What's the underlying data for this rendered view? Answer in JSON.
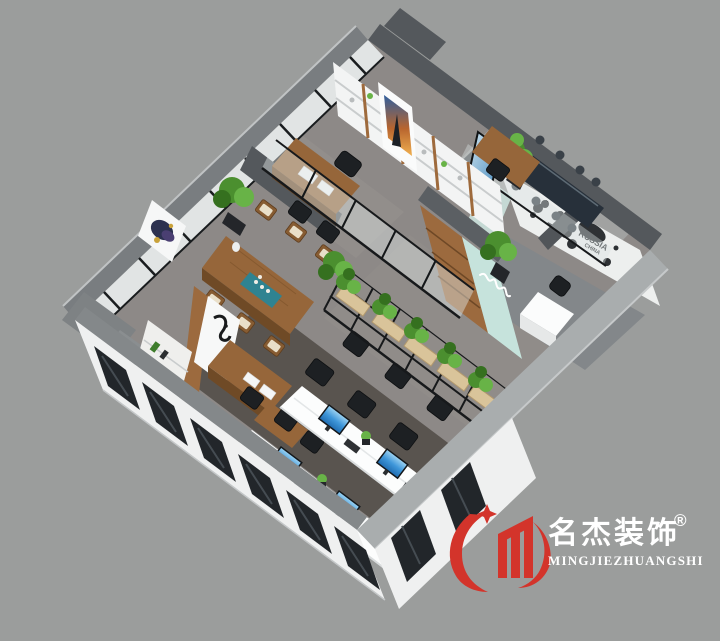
{
  "scene": {
    "description": "3D isometric cutaway rendering of an office interior floor plan on a gray backdrop",
    "background": "#9b9d9c"
  },
  "branding": {
    "logo_text_zh": "名杰装饰",
    "registered_mark": "®",
    "logo_text_en": "MINGJIEZHUANGSHI"
  },
  "map_wall": {
    "label_russia": "RUSSIA",
    "label_china": "CHINA"
  },
  "rooms": [
    "executive-office",
    "library-office",
    "media-room",
    "conference-room",
    "reception-with-world-map",
    "tea-meeting-area",
    "staff-office",
    "open-plan-office",
    "plant-partition"
  ],
  "colors": {
    "background": "#9b9d9c",
    "wall_dark": "#54585c",
    "wall_medium": "#797d80",
    "band_light": "#a9adae",
    "band_mid": "#84888a",
    "facade_white": "#eff0f0",
    "window_dark": "#22262a",
    "glass_white": "#e8ebeb",
    "floor_base": "#8d8987",
    "carpet_dark": "#59544f",
    "corridor_tile": "#908c89",
    "wood": "#96663a",
    "wood_dark": "#6f4a26",
    "shelf_white": "#f3f4f4",
    "mint": "#c6e3dc",
    "teal": "#2f8391",
    "plant_green": "#4b8f2f",
    "plant_light": "#68b347",
    "plant_dark": "#35701f",
    "screen_blue": "#2e86cf",
    "chair_black": "#1d2023",
    "map_decal": "#2e3134",
    "logo_red": "#d3342b",
    "white": "#ffffff"
  }
}
